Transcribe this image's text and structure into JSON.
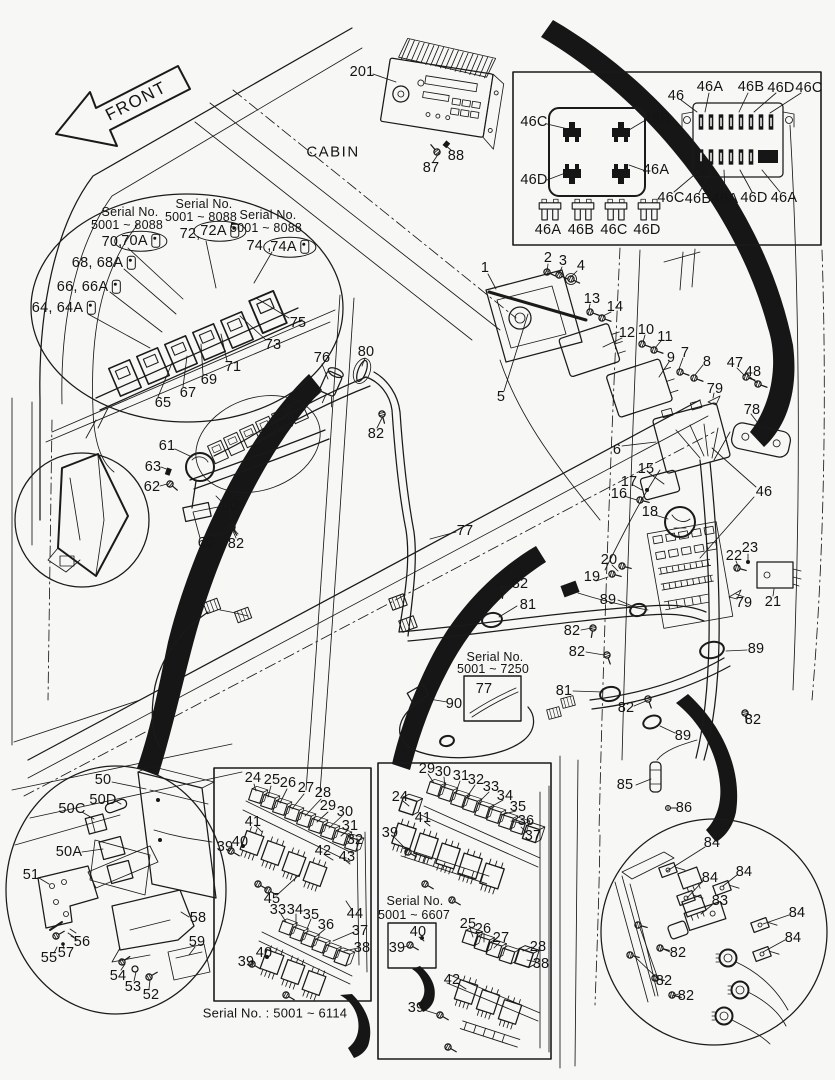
{
  "ink": "#1a1a1a",
  "background": "#f7f7f5",
  "sections": [
    {
      "name": "header",
      "labels": [
        {
          "t": "FRONT",
          "x": 136,
          "y": 101,
          "fs": 17,
          "rot": -27,
          "ls": 1.5
        },
        {
          "t": "CABIN",
          "x": 333,
          "y": 152,
          "fs": 15,
          "ls": 1.5
        },
        {
          "t": "201",
          "x": 362,
          "y": 72
        },
        {
          "t": "88",
          "x": 456,
          "y": 156
        },
        {
          "t": "87",
          "x": 431,
          "y": 168
        }
      ]
    },
    {
      "name": "fuse-box-inset",
      "labels": [
        {
          "t": "46C",
          "x": 534,
          "y": 122
        },
        {
          "t": "46B",
          "x": 657,
          "y": 119
        },
        {
          "t": "46D",
          "x": 534,
          "y": 180
        },
        {
          "t": "46A",
          "x": 656,
          "y": 170
        },
        {
          "t": "46",
          "x": 676,
          "y": 96
        },
        {
          "t": "46A",
          "x": 710,
          "y": 87
        },
        {
          "t": "46B",
          "x": 751,
          "y": 87
        },
        {
          "t": "46D",
          "x": 781,
          "y": 88
        },
        {
          "t": "46C",
          "x": 809,
          "y": 88
        },
        {
          "t": "46C",
          "x": 671,
          "y": 198
        },
        {
          "t": "46B",
          "x": 698,
          "y": 199
        },
        {
          "t": "46A",
          "x": 725,
          "y": 199
        },
        {
          "t": "46D",
          "x": 754,
          "y": 198
        },
        {
          "t": "46A",
          "x": 784,
          "y": 198
        },
        {
          "t": "46A",
          "x": 548,
          "y": 230
        },
        {
          "t": "46B",
          "x": 581,
          "y": 230
        },
        {
          "t": "46C",
          "x": 614,
          "y": 230
        },
        {
          "t": "46D",
          "x": 647,
          "y": 230
        }
      ]
    },
    {
      "name": "relay-inset",
      "labels": [
        {
          "t": "Serial No.",
          "x": 130,
          "y": 212,
          "fs": 12.5
        },
        {
          "t": "5001 ~ 8088",
          "x": 127,
          "y": 225,
          "fs": 12.5
        },
        {
          "t": "Serial No.",
          "x": 204,
          "y": 204,
          "fs": 12.5
        },
        {
          "t": "5001 ~ 8088",
          "x": 201,
          "y": 217,
          "fs": 12.5
        },
        {
          "t": "Serial No.",
          "x": 268,
          "y": 215,
          "fs": 12.5
        },
        {
          "t": "5001 ~ 8088",
          "x": 266,
          "y": 228,
          "fs": 12.5
        },
        {
          "t": "70,",
          "x": 112,
          "y": 242
        },
        {
          "t": "70A",
          "x": 141,
          "y": 241,
          "circ": true,
          "icon": true
        },
        {
          "t": "72,",
          "x": 190,
          "y": 234
        },
        {
          "t": "72A",
          "x": 220,
          "y": 231,
          "circ": true,
          "icon": true
        },
        {
          "t": "74 ,",
          "x": 259,
          "y": 246
        },
        {
          "t": "74A",
          "x": 290,
          "y": 247,
          "circ": true,
          "icon": true
        },
        {
          "t": "68, 68A",
          "x": 104,
          "y": 263,
          "icon": true
        },
        {
          "t": "66, 66A",
          "x": 89,
          "y": 287,
          "icon": true
        },
        {
          "t": "64, 64A",
          "x": 64,
          "y": 308,
          "icon": true
        },
        {
          "t": "75",
          "x": 298,
          "y": 323
        },
        {
          "t": "73",
          "x": 273,
          "y": 345
        },
        {
          "t": "71",
          "x": 233,
          "y": 367
        },
        {
          "t": "69",
          "x": 209,
          "y": 380
        },
        {
          "t": "67",
          "x": 188,
          "y": 393
        },
        {
          "t": "65",
          "x": 163,
          "y": 403
        }
      ]
    },
    {
      "name": "main-harness",
      "labels": [
        {
          "t": "76",
          "x": 322,
          "y": 358
        },
        {
          "t": "80",
          "x": 366,
          "y": 352
        },
        {
          "t": "82",
          "x": 376,
          "y": 434
        },
        {
          "t": "61",
          "x": 167,
          "y": 446
        },
        {
          "t": "63",
          "x": 153,
          "y": 467
        },
        {
          "t": "62",
          "x": 152,
          "y": 487
        },
        {
          "t": "80",
          "x": 230,
          "y": 506
        },
        {
          "t": "60",
          "x": 206,
          "y": 543
        },
        {
          "t": "82",
          "x": 236,
          "y": 544
        },
        {
          "t": "77",
          "x": 465,
          "y": 531
        }
      ]
    },
    {
      "name": "right-assembly",
      "labels": [
        {
          "t": "1",
          "x": 485,
          "y": 268
        },
        {
          "t": "2",
          "x": 548,
          "y": 258
        },
        {
          "t": "3",
          "x": 563,
          "y": 261
        },
        {
          "t": "4",
          "x": 581,
          "y": 266
        },
        {
          "t": "13",
          "x": 592,
          "y": 299
        },
        {
          "t": "14",
          "x": 615,
          "y": 307
        },
        {
          "t": "12",
          "x": 627,
          "y": 333
        },
        {
          "t": "10",
          "x": 646,
          "y": 330
        },
        {
          "t": "11",
          "x": 665,
          "y": 337
        },
        {
          "t": "9",
          "x": 671,
          "y": 358
        },
        {
          "t": "7",
          "x": 685,
          "y": 353
        },
        {
          "t": "8",
          "x": 707,
          "y": 362
        },
        {
          "t": "47",
          "x": 735,
          "y": 363
        },
        {
          "t": "48",
          "x": 753,
          "y": 372
        },
        {
          "t": "79",
          "x": 715,
          "y": 389
        },
        {
          "t": "78",
          "x": 752,
          "y": 410
        },
        {
          "t": "5",
          "x": 501,
          "y": 397
        },
        {
          "t": "6",
          "x": 617,
          "y": 450
        },
        {
          "t": "15",
          "x": 646,
          "y": 469
        },
        {
          "t": "17",
          "x": 629,
          "y": 482
        },
        {
          "t": "16",
          "x": 619,
          "y": 494
        },
        {
          "t": "18",
          "x": 650,
          "y": 512
        },
        {
          "t": "46",
          "x": 764,
          "y": 492
        },
        {
          "t": "20",
          "x": 609,
          "y": 560
        },
        {
          "t": "19",
          "x": 592,
          "y": 577
        },
        {
          "t": "22",
          "x": 734,
          "y": 556
        },
        {
          "t": "23",
          "x": 750,
          "y": 548
        },
        {
          "t": "79",
          "x": 744,
          "y": 603
        },
        {
          "t": "21",
          "x": 773,
          "y": 602
        },
        {
          "t": "89",
          "x": 608,
          "y": 600
        }
      ]
    },
    {
      "name": "center-harness",
      "labels": [
        {
          "t": "82",
          "x": 520,
          "y": 584
        },
        {
          "t": "81",
          "x": 528,
          "y": 605
        },
        {
          "t": "82",
          "x": 572,
          "y": 631
        },
        {
          "t": "82",
          "x": 577,
          "y": 652
        },
        {
          "t": "Serial No.",
          "x": 495,
          "y": 657,
          "fs": 12.5
        },
        {
          "t": "5001 ~ 7250",
          "x": 493,
          "y": 669,
          "fs": 12.5
        },
        {
          "t": "77",
          "x": 484,
          "y": 689
        },
        {
          "t": "90",
          "x": 454,
          "y": 704
        },
        {
          "t": "81",
          "x": 564,
          "y": 691
        },
        {
          "t": "89",
          "x": 756,
          "y": 649
        },
        {
          "t": "82",
          "x": 626,
          "y": 708
        },
        {
          "t": "89",
          "x": 683,
          "y": 736
        },
        {
          "t": "82",
          "x": 753,
          "y": 720
        },
        {
          "t": "85",
          "x": 625,
          "y": 785
        },
        {
          "t": "86",
          "x": 684,
          "y": 808
        }
      ]
    },
    {
      "name": "lamp-inset",
      "labels": [
        {
          "t": "50",
          "x": 103,
          "y": 780
        },
        {
          "t": "50D",
          "x": 103,
          "y": 800
        },
        {
          "t": "50C",
          "x": 72,
          "y": 809
        },
        {
          "t": "50A",
          "x": 69,
          "y": 852
        },
        {
          "t": "51",
          "x": 31,
          "y": 875
        },
        {
          "t": "58",
          "x": 198,
          "y": 918
        },
        {
          "t": "59",
          "x": 197,
          "y": 942
        },
        {
          "t": "56",
          "x": 82,
          "y": 942
        },
        {
          "t": "57",
          "x": 66,
          "y": 953
        },
        {
          "t": "55",
          "x": 49,
          "y": 958
        },
        {
          "t": "54",
          "x": 118,
          "y": 976
        },
        {
          "t": "53",
          "x": 133,
          "y": 987
        },
        {
          "t": "52",
          "x": 151,
          "y": 995
        }
      ]
    },
    {
      "name": "relay-box-6114",
      "labels": [
        {
          "t": "24",
          "x": 253,
          "y": 778
        },
        {
          "t": "25",
          "x": 272,
          "y": 780
        },
        {
          "t": "26",
          "x": 288,
          "y": 783
        },
        {
          "t": "27",
          "x": 306,
          "y": 788
        },
        {
          "t": "28",
          "x": 323,
          "y": 793
        },
        {
          "t": "29",
          "x": 328,
          "y": 806
        },
        {
          "t": "30",
          "x": 345,
          "y": 812
        },
        {
          "t": "31",
          "x": 350,
          "y": 826
        },
        {
          "t": "32",
          "x": 355,
          "y": 840
        },
        {
          "t": "41",
          "x": 253,
          "y": 822
        },
        {
          "t": "40",
          "x": 240,
          "y": 842
        },
        {
          "t": "39",
          "x": 225,
          "y": 847
        },
        {
          "t": "42",
          "x": 323,
          "y": 851
        },
        {
          "t": "43",
          "x": 347,
          "y": 857
        },
        {
          "t": "45",
          "x": 272,
          "y": 899
        },
        {
          "t": "44",
          "x": 355,
          "y": 914
        },
        {
          "t": "33",
          "x": 278,
          "y": 910
        },
        {
          "t": "34",
          "x": 295,
          "y": 910
        },
        {
          "t": "35",
          "x": 311,
          "y": 915
        },
        {
          "t": "36",
          "x": 326,
          "y": 925
        },
        {
          "t": "37",
          "x": 360,
          "y": 931
        },
        {
          "t": "38",
          "x": 362,
          "y": 948
        },
        {
          "t": "40",
          "x": 264,
          "y": 953
        },
        {
          "t": "39",
          "x": 246,
          "y": 962
        },
        {
          "t": "Serial No. : 5001 ~ 6114",
          "x": 275,
          "y": 1013,
          "fs": 13
        }
      ]
    },
    {
      "name": "relay-box-6607",
      "labels": [
        {
          "t": "29",
          "x": 427,
          "y": 769
        },
        {
          "t": "30",
          "x": 443,
          "y": 772
        },
        {
          "t": "31",
          "x": 461,
          "y": 776
        },
        {
          "t": "32",
          "x": 476,
          "y": 780
        },
        {
          "t": "33",
          "x": 491,
          "y": 787
        },
        {
          "t": "34",
          "x": 505,
          "y": 796
        },
        {
          "t": "35",
          "x": 518,
          "y": 807
        },
        {
          "t": "36",
          "x": 526,
          "y": 821
        },
        {
          "t": "37",
          "x": 533,
          "y": 836
        },
        {
          "t": "24",
          "x": 400,
          "y": 797
        },
        {
          "t": "41",
          "x": 423,
          "y": 818
        },
        {
          "t": "39",
          "x": 390,
          "y": 833
        },
        {
          "t": "Serial No.",
          "x": 415,
          "y": 901,
          "fs": 12.5
        },
        {
          "t": "5001 ~ 6607",
          "x": 414,
          "y": 915,
          "fs": 12.5
        },
        {
          "t": "40",
          "x": 418,
          "y": 932
        },
        {
          "t": "39",
          "x": 397,
          "y": 948
        },
        {
          "t": "25",
          "x": 468,
          "y": 924
        },
        {
          "t": "26",
          "x": 483,
          "y": 929
        },
        {
          "t": "27",
          "x": 501,
          "y": 938
        },
        {
          "t": "28",
          "x": 538,
          "y": 947
        },
        {
          "t": "38",
          "x": 541,
          "y": 964
        },
        {
          "t": "42",
          "x": 452,
          "y": 980
        },
        {
          "t": "39",
          "x": 416,
          "y": 1008
        }
      ]
    },
    {
      "name": "terminal-inset",
      "labels": [
        {
          "t": "84",
          "x": 712,
          "y": 843
        },
        {
          "t": "84",
          "x": 744,
          "y": 872
        },
        {
          "t": "84",
          "x": 710,
          "y": 878
        },
        {
          "t": "83",
          "x": 720,
          "y": 901
        },
        {
          "t": "84",
          "x": 797,
          "y": 913
        },
        {
          "t": "84",
          "x": 793,
          "y": 938
        },
        {
          "t": "82",
          "x": 678,
          "y": 953
        },
        {
          "t": "82",
          "x": 664,
          "y": 981
        },
        {
          "t": "82",
          "x": 686,
          "y": 996
        }
      ]
    }
  ]
}
